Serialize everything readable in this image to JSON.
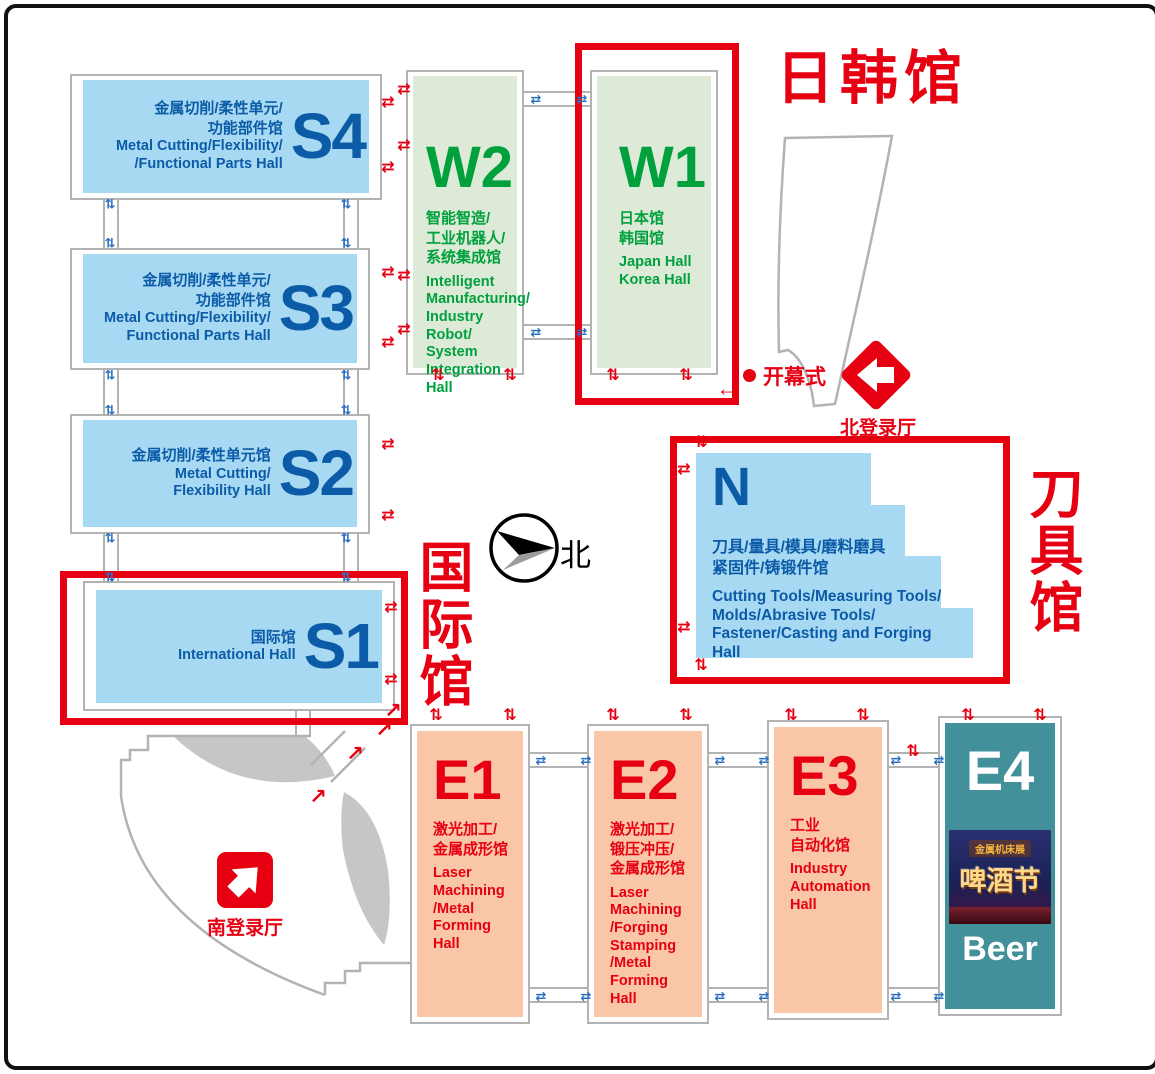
{
  "colors": {
    "accent_red": "#e60012",
    "blue_fill": "#a8d9f3",
    "blue_text": "#0b5ba7",
    "green_fill": "#dcead7",
    "green_text": "#00a13d",
    "peach_fill": "#f9c7a7",
    "teal_fill": "#42909a",
    "gray_line": "#b3b3b3",
    "gray_fill": "#c6c6c6"
  },
  "areas": {
    "jp_kr": "日韩馆",
    "intl": "国际馆",
    "tools": "刀具馆"
  },
  "halls": {
    "s4": {
      "id": "S4",
      "zh": "金属切削/柔性单元/\n功能部件馆",
      "en": "Metal Cutting/Flexibility/\n/Functional Parts Hall"
    },
    "s3": {
      "id": "S3",
      "zh": "金属切削/柔性单元/\n功能部件馆",
      "en": "Metal Cutting/Flexibility/\nFunctional Parts Hall"
    },
    "s2": {
      "id": "S2",
      "zh": "金属切削/柔性单元馆",
      "en": "Metal Cutting/\nFlexibility Hall"
    },
    "s1": {
      "id": "S1",
      "zh": "国际馆",
      "en": "International Hall"
    },
    "w2": {
      "id": "W2",
      "zh": "智能智造/\n工业机器人/\n系统集成馆",
      "en": "Intelligent\nManufacturing/\nIndustry Robot/\nSystem\nIntegration Hall"
    },
    "w1": {
      "id": "W1",
      "zh": "日本馆\n韩国馆",
      "en": "Japan Hall\nKorea Hall"
    },
    "n": {
      "id": "N",
      "zh": "刀具/量具/模具/磨料磨具\n紧固件/铸锻件馆",
      "en": "Cutting Tools/Measuring Tools/\nMolds/Abrasive Tools/\nFastener/Casting and Forging\nHall"
    },
    "e1": {
      "id": "E1",
      "zh": "激光加工/\n金属成形馆",
      "en": "Laser\nMachining\n/Metal\nForming\nHall"
    },
    "e2": {
      "id": "E2",
      "zh": "激光加工/\n锻压冲压/\n金属成形馆",
      "en": "Laser\nMachining\n/Forging\nStamping\n/Metal\nForming\nHall"
    },
    "e3": {
      "id": "E3",
      "zh": "工业\n自动化馆",
      "en": "Industry\nAutomation\nHall"
    },
    "e4": {
      "id": "E4",
      "beer": "Beer",
      "poster_ribbon": "金属机床展",
      "poster_title": "啤酒节"
    }
  },
  "markers": {
    "opening": "开幕式",
    "north_entrance": "北登录厅",
    "south_entrance": "南登录厅",
    "compass": "北"
  },
  "icons": {
    "transfer": [
      {
        "o": "h",
        "c": "red",
        "x": 380,
        "y": 95
      },
      {
        "o": "h",
        "c": "red",
        "x": 380,
        "y": 160
      },
      {
        "o": "h",
        "c": "red",
        "x": 380,
        "y": 265
      },
      {
        "o": "h",
        "c": "red",
        "x": 380,
        "y": 335
      },
      {
        "o": "h",
        "c": "red",
        "x": 380,
        "y": 437
      },
      {
        "o": "h",
        "c": "red",
        "x": 380,
        "y": 508
      },
      {
        "o": "h",
        "c": "red",
        "x": 383,
        "y": 600
      },
      {
        "o": "h",
        "c": "red",
        "x": 383,
        "y": 672
      },
      {
        "o": "h",
        "c": "red",
        "x": 396,
        "y": 82
      },
      {
        "o": "h",
        "c": "red",
        "x": 396,
        "y": 138
      },
      {
        "o": "h",
        "c": "red",
        "x": 396,
        "y": 268
      },
      {
        "o": "h",
        "c": "red",
        "x": 396,
        "y": 322
      },
      {
        "o": "h",
        "c": "red",
        "x": 676,
        "y": 462
      },
      {
        "o": "h",
        "c": "red",
        "x": 676,
        "y": 620
      },
      {
        "o": "v",
        "c": "red",
        "x": 430,
        "y": 368
      },
      {
        "o": "v",
        "c": "red",
        "x": 502,
        "y": 368
      },
      {
        "o": "v",
        "c": "red",
        "x": 605,
        "y": 368
      },
      {
        "o": "v",
        "c": "red",
        "x": 678,
        "y": 368
      },
      {
        "o": "v",
        "c": "red",
        "x": 428,
        "y": 708
      },
      {
        "o": "v",
        "c": "red",
        "x": 502,
        "y": 708
      },
      {
        "o": "v",
        "c": "red",
        "x": 605,
        "y": 708
      },
      {
        "o": "v",
        "c": "red",
        "x": 678,
        "y": 708
      },
      {
        "o": "v",
        "c": "red",
        "x": 783,
        "y": 708
      },
      {
        "o": "v",
        "c": "red",
        "x": 855,
        "y": 708
      },
      {
        "o": "v",
        "c": "red",
        "x": 960,
        "y": 708
      },
      {
        "o": "v",
        "c": "red",
        "x": 1032,
        "y": 708
      },
      {
        "o": "v",
        "c": "red",
        "x": 693,
        "y": 435
      },
      {
        "o": "v",
        "c": "red",
        "x": 693,
        "y": 658
      },
      {
        "o": "v",
        "c": "red",
        "x": 905,
        "y": 744
      },
      {
        "o": "h",
        "c": "blue",
        "x": 528,
        "y": 91
      },
      {
        "o": "h",
        "c": "blue",
        "x": 574,
        "y": 91
      },
      {
        "o": "h",
        "c": "blue",
        "x": 528,
        "y": 324
      },
      {
        "o": "h",
        "c": "blue",
        "x": 574,
        "y": 324
      },
      {
        "o": "h",
        "c": "blue",
        "x": 533,
        "y": 752
      },
      {
        "o": "h",
        "c": "blue",
        "x": 578,
        "y": 752
      },
      {
        "o": "h",
        "c": "blue",
        "x": 533,
        "y": 988
      },
      {
        "o": "h",
        "c": "blue",
        "x": 578,
        "y": 988
      },
      {
        "o": "h",
        "c": "blue",
        "x": 712,
        "y": 752
      },
      {
        "o": "h",
        "c": "blue",
        "x": 756,
        "y": 752
      },
      {
        "o": "h",
        "c": "blue",
        "x": 712,
        "y": 988
      },
      {
        "o": "h",
        "c": "blue",
        "x": 756,
        "y": 988
      },
      {
        "o": "h",
        "c": "blue",
        "x": 888,
        "y": 752
      },
      {
        "o": "h",
        "c": "blue",
        "x": 931,
        "y": 752
      },
      {
        "o": "h",
        "c": "blue",
        "x": 888,
        "y": 988
      },
      {
        "o": "h",
        "c": "blue",
        "x": 931,
        "y": 988
      },
      {
        "o": "v",
        "c": "blue",
        "x": 102,
        "y": 196
      },
      {
        "o": "v",
        "c": "blue",
        "x": 338,
        "y": 196
      },
      {
        "o": "v",
        "c": "blue",
        "x": 102,
        "y": 235
      },
      {
        "o": "v",
        "c": "blue",
        "x": 338,
        "y": 235
      },
      {
        "o": "v",
        "c": "blue",
        "x": 102,
        "y": 367
      },
      {
        "o": "v",
        "c": "blue",
        "x": 338,
        "y": 367
      },
      {
        "o": "v",
        "c": "blue",
        "x": 102,
        "y": 402
      },
      {
        "o": "v",
        "c": "blue",
        "x": 338,
        "y": 402
      },
      {
        "o": "v",
        "c": "blue",
        "x": 102,
        "y": 530
      },
      {
        "o": "v",
        "c": "blue",
        "x": 338,
        "y": 530
      },
      {
        "o": "v",
        "c": "blue",
        "x": 102,
        "y": 569
      },
      {
        "o": "v",
        "c": "blue",
        "x": 338,
        "y": 569
      }
    ],
    "route_arrows": [
      {
        "g": "↗",
        "x": 310,
        "y": 789
      },
      {
        "g": "↗",
        "x": 347,
        "y": 746
      },
      {
        "g": "↗",
        "x": 376,
        "y": 722
      },
      {
        "g": "↗",
        "x": 385,
        "y": 703
      },
      {
        "g": "←",
        "x": 719,
        "y": 381
      }
    ]
  }
}
